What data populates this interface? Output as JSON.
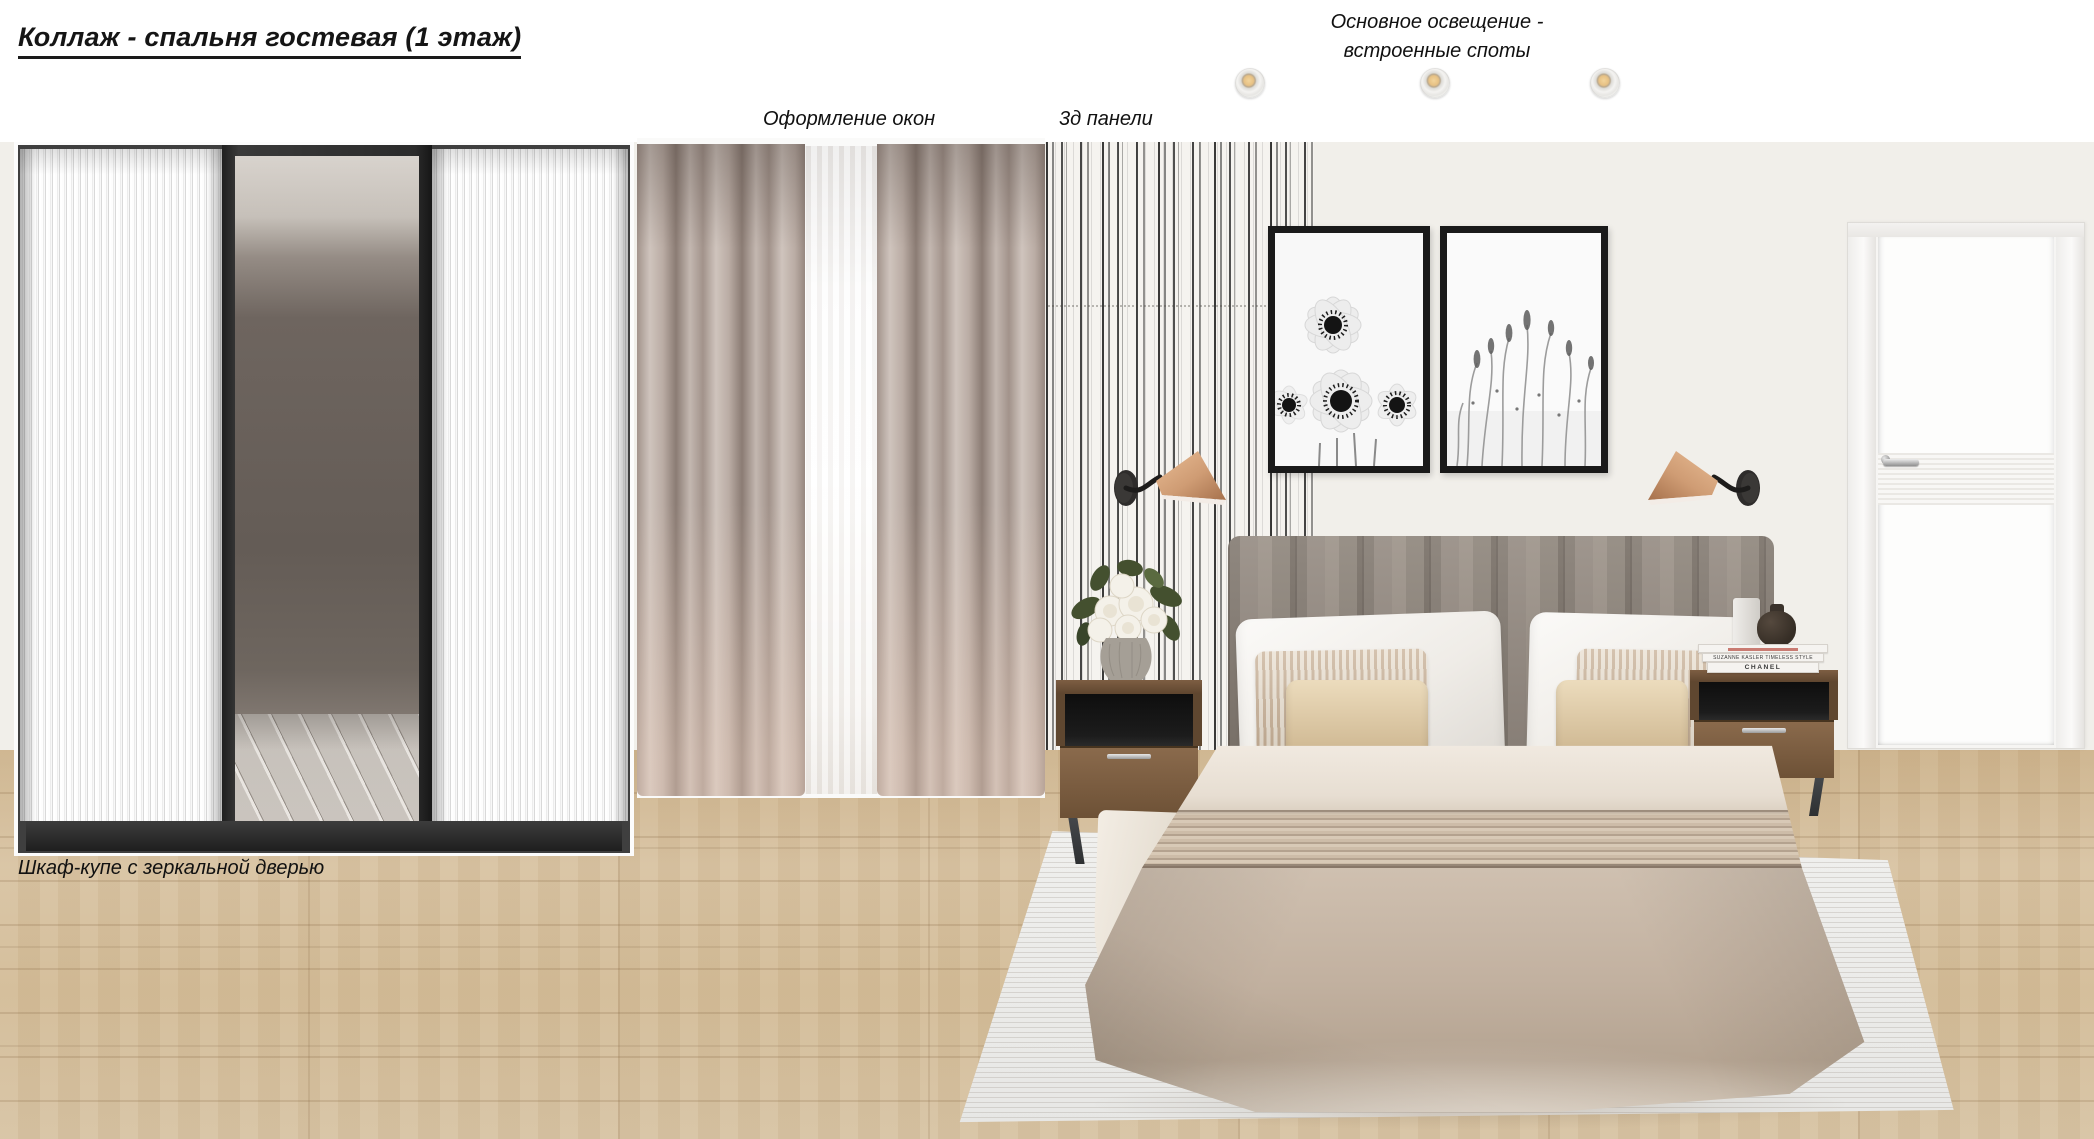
{
  "page": {
    "title": "Коллаж - спальня гостевая (1 этаж)"
  },
  "labels": {
    "windows": "Оформление окон",
    "panels": "3д панели",
    "lighting1": "Основное освещение -",
    "lighting2": "встроенные споты",
    "wardrobe": "Шкаф-купе с зеркальной дверью"
  },
  "books": {
    "middle": "SUZANNE KASLER TIMELESS STYLE",
    "bottom": "CHANEL"
  },
  "lighting": {
    "spot_count": 3
  },
  "colors": {
    "ceiling": "#ffffff",
    "wall": "#f1efea",
    "floor_wood": "#d3bc97",
    "panels_stripe": "#2a2a2a",
    "curtain": "#b3a69e",
    "headboard": "#8b8178",
    "duvet": "#c2b1a0",
    "sconce_copper": "#cf9c74",
    "nightstand_wood": "#7a5c41",
    "rug": "#ebebe9",
    "frame_black": "#1a1a1a"
  }
}
